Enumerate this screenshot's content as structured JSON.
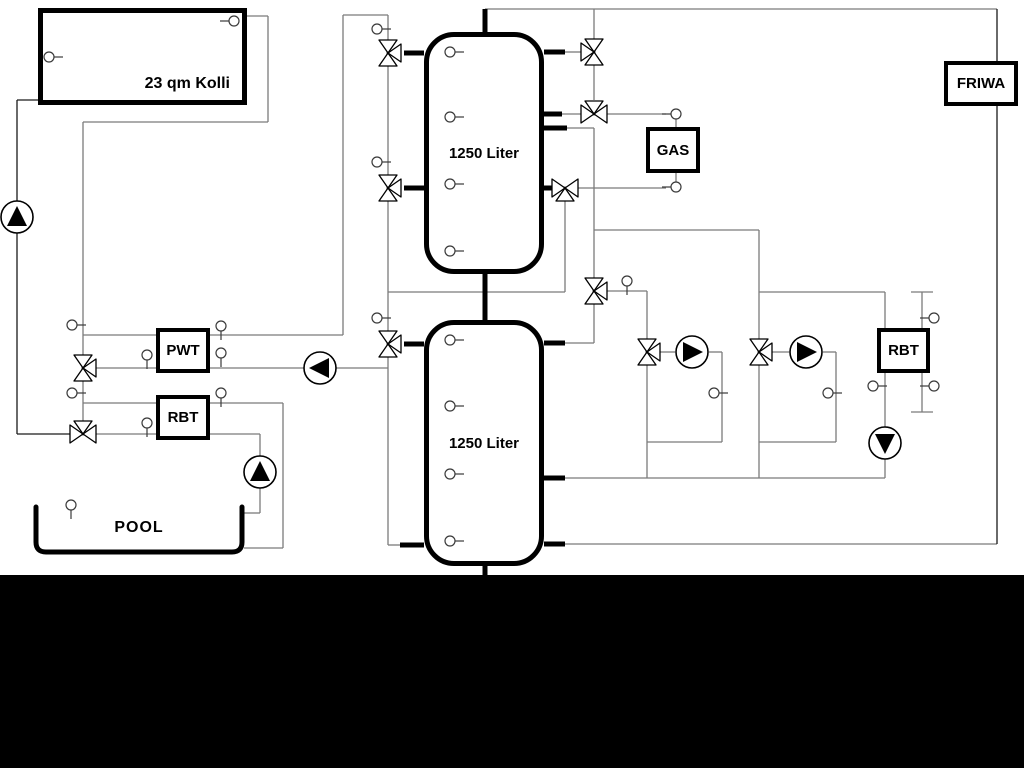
{
  "diagram": {
    "labels": {
      "collector": "23 qm Kolli",
      "tank_top": "1250 Liter",
      "tank_bottom": "1250 Liter",
      "gas": "GAS",
      "friwa": "FRIWA",
      "pwt": "PWT",
      "rbt_left": "RBT",
      "rbt_right": "RBT",
      "pool": "POOL"
    },
    "colors": {
      "pipe": "#7b7b7b",
      "dark_pipe": "#1a1a1a",
      "component_stroke": "#000000",
      "sensor_stroke": "#3a3a3a",
      "background": "#ffffff",
      "bottom_band": "#000000"
    }
  }
}
